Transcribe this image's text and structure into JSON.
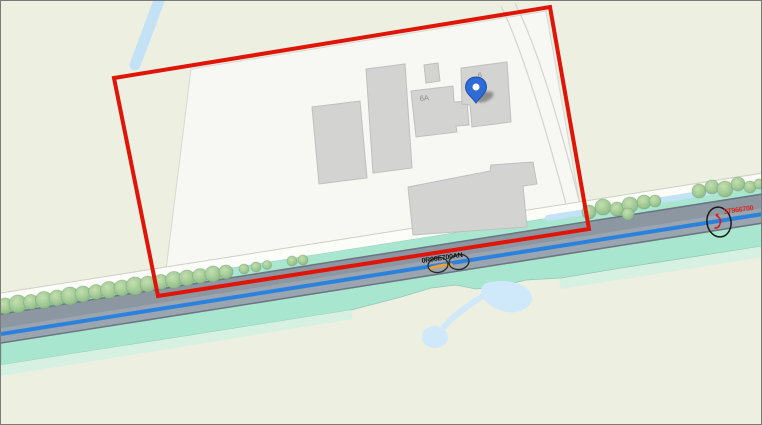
{
  "map": {
    "type": "cadastral-waterway-map",
    "background_color": "#edefe1",
    "labels": {
      "building_6a": "6A",
      "building_6": "6",
      "road_asset": "0R96E700AN",
      "marker_asset": "3T966700"
    },
    "marker": {
      "icon": "location-pin",
      "color": "#2e6bd6"
    },
    "colors": {
      "selection_rectangle": "#de1508",
      "waterway_line": "#2b82dd",
      "ditch": "#c2e2f5",
      "canal_bank": "#a9e6d0",
      "road": "#939ea9",
      "building": "#d3d3d2",
      "pond": "#cfe8fa",
      "tree": "#9cc794",
      "marker_text_red": "#e02520",
      "road_label_text": "#151515"
    }
  }
}
